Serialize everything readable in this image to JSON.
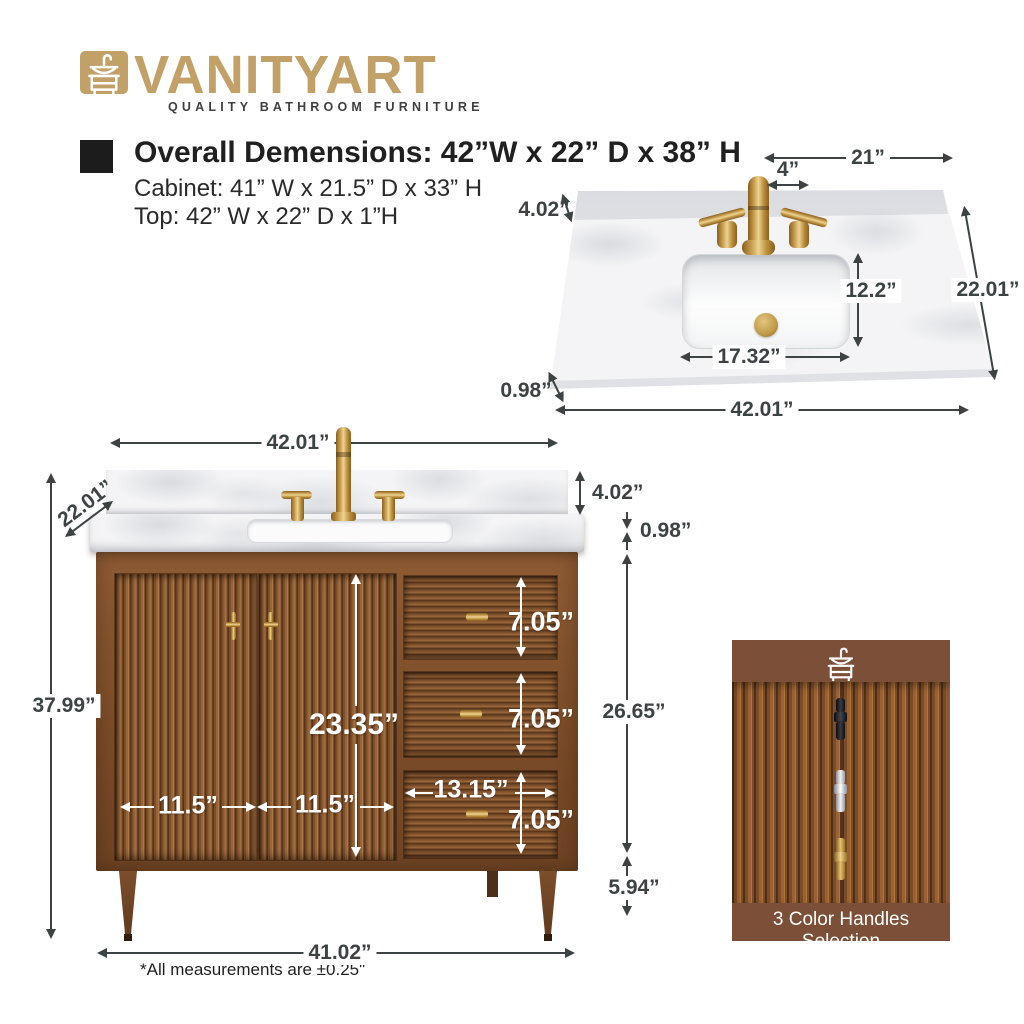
{
  "brand": {
    "name": "VANITYART",
    "tagline": "QUALITY BATHROOM FURNITURE",
    "gold": "#C2A169"
  },
  "specs": {
    "overall": "Overall Demensions: 42”W x 22” D x 38” H",
    "cabinet": "Cabinet: 41” W x 21.5” D x 33” H",
    "top": "Top: 42” W x 22” D x 1”H"
  },
  "top_view": {
    "faucet_to_edge": "21”",
    "faucet_hole_spacing": "4”",
    "backsplash_height": "4.02”",
    "sink_front_to_back": "12.2”",
    "counter_depth": "22.01”",
    "sink_width": "17.32”",
    "counter_thickness": "0.98”",
    "counter_width": "42.01”"
  },
  "front_view": {
    "counter_width": "42.01”",
    "counter_depth": "22.01”",
    "backsplash_height": "4.02”",
    "counter_thickness": "0.98”",
    "overall_height": "37.99”",
    "door_opening_height": "23.35”",
    "drawer_height_1": "7.05”",
    "drawer_height_2": "7.05”",
    "drawer_height_3": "7.05”",
    "drawer_width": "13.15”",
    "left_door_width": "11.5”",
    "right_door_width": "11.5”",
    "cabinet_body_height": "26.65”",
    "leg_height": "5.94”",
    "base_width": "41.02”"
  },
  "footnote": "*All measurements are ±0.25\"",
  "handles_panel": {
    "title": "3 Color Handles Selection",
    "options": [
      {
        "name": "black-handle",
        "color": "#1E1E22"
      },
      {
        "name": "chrome-handle",
        "color": "#D9D9DC"
      },
      {
        "name": "gold-handle",
        "color": "#C9A255"
      }
    ]
  },
  "palette": {
    "wood": "#8A5731",
    "panel_brown": "#7B4F38",
    "dimension_text": "#3D4243",
    "marble": "#F4F4F6",
    "gold": "#C9A255"
  }
}
